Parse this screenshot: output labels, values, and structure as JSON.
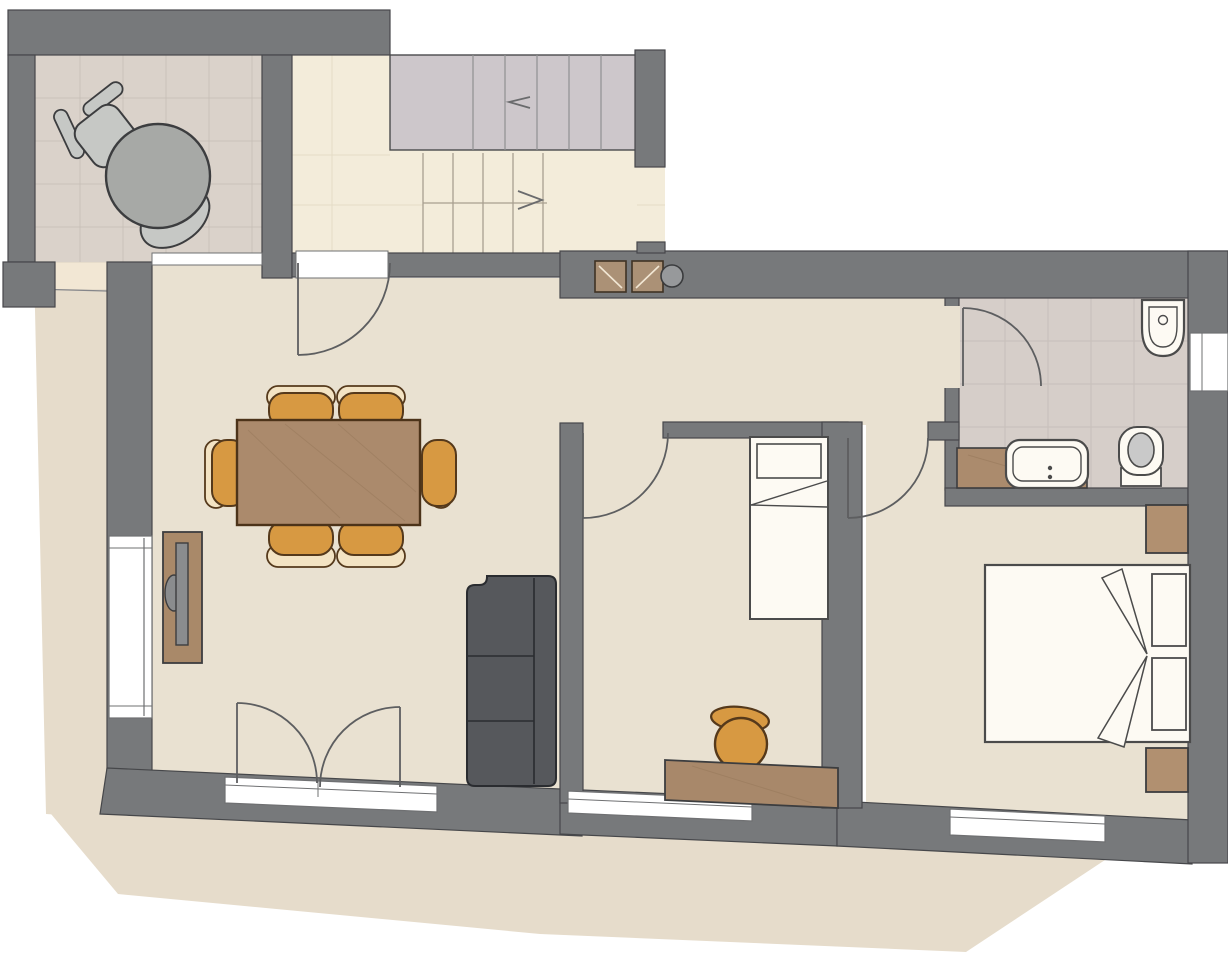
{
  "document": {
    "kind": "architectural-floor-plan",
    "view": "top-down apartment plan with balcony, stair hall, living-dining room, two bedrooms and bathroom"
  },
  "colors": {
    "white": "#ffffff",
    "wall": "#77797b",
    "wallLine": "#46474a",
    "balconyTile": "#dad2ca",
    "balconyTileLine": "#c9c1b9",
    "hallFloor": "#f3ecda",
    "hallLine": "#e4dcc6",
    "livingFloor": "#e9e1d1",
    "bathTile": "#d6cec9",
    "bathTileLine": "#c7bfba",
    "stairUpper": "#cdc7cb",
    "stairTread": "#8f9092",
    "lowerTread": "#a89f8f",
    "apron": "#e6dccb",
    "apronLine": "#85868a",
    "walkwayPatch": "#f2e7d4",
    "fixture": "#fdfaf3",
    "fixtureLine": "#4b4b4b",
    "wood": "#ab8a6c",
    "woodDark": "#4c3319",
    "woodGrain": "#9b7c5e",
    "desk": "#a8886a",
    "counter": "#ab8b6d",
    "nightstand": "#b19070",
    "chairOrange": "#d79942",
    "chairLight": "#f3e3c3",
    "chairLine": "#55391b",
    "sofa": "#56585c",
    "sofaLine": "#2a2c30",
    "tvStand": "#a98969",
    "tv": "#8a8c8e",
    "grayFurn": "#a7a9a6",
    "grayFurnLight": "#c6c8c5",
    "furnLine": "#3c3d3f",
    "doorArc": "#5d5e60",
    "seatGray": "#c9c9c9",
    "cabinet": "#ab9176",
    "cabinetLine": "#3f3224",
    "column": "#97999b",
    "windowLine": "#6f7072"
  },
  "elements": {
    "rooms": [
      "balcony",
      "stair-hall",
      "living-dining-room",
      "hallway",
      "middle-bedroom",
      "master-bedroom",
      "bathroom"
    ],
    "furniture": [
      "balcony-round-table",
      "balcony-chair",
      "dining-table",
      "dining-chairs-x6",
      "tv-sideboard",
      "sofa-3-seat",
      "single-bed",
      "desk",
      "desk-chair",
      "double-bed",
      "nightstand-x2",
      "vanity-counter",
      "washbasin",
      "toilet",
      "bidet",
      "wall-cabinets-x2",
      "column"
    ],
    "openings": [
      "entry-door",
      "balcony-window",
      "left-window",
      "french-balcony-door",
      "middle-bedroom-door",
      "master-bedroom-door",
      "bathroom-door",
      "bathroom-window",
      "middle-bedroom-window",
      "master-bedroom-window"
    ],
    "stairs": [
      "upper-flight",
      "lower-flight",
      "direction-arrows"
    ]
  }
}
